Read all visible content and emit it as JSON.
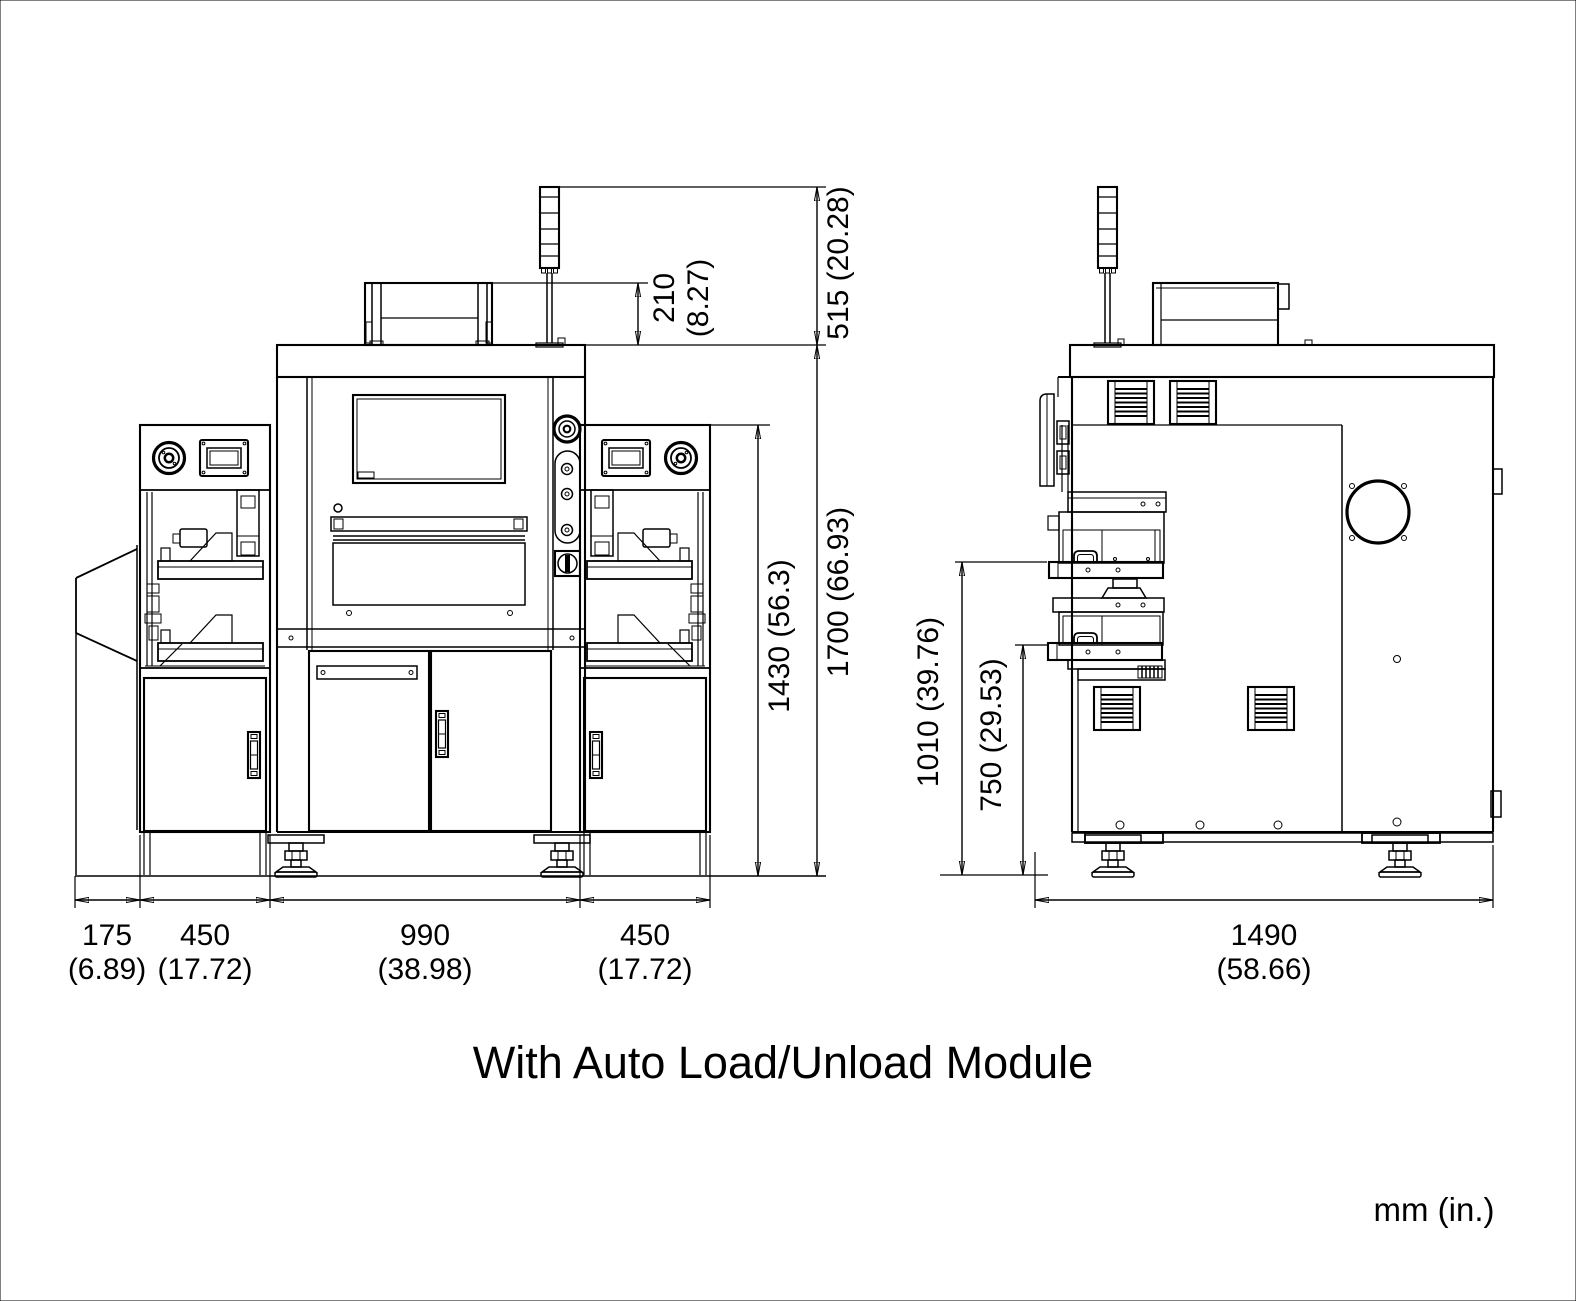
{
  "caption": "With Auto Load/Unload Module",
  "units": "mm (in.)",
  "front": {
    "dim_top_box_height": {
      "mm": "210",
      "in": "(8.27)"
    },
    "dim_tower_height": "515 (20.28)",
    "dim_wing_height": "1430 (56.3)",
    "dim_total_height": "1700 (66.93)",
    "dim_chute_width": {
      "mm": "175",
      "in": "(6.89)"
    },
    "dim_left_module_width": {
      "mm": "450",
      "in": "(17.72)"
    },
    "dim_body_width": {
      "mm": "990",
      "in": "(38.98)"
    },
    "dim_right_module_width": {
      "mm": "450",
      "in": "(17.72)"
    }
  },
  "side": {
    "dim_upper_tray_height": "1010 (39.76)",
    "dim_lower_tray_height": "750 (29.53)",
    "dim_depth": {
      "mm": "1490",
      "in": "(58.66)"
    }
  }
}
